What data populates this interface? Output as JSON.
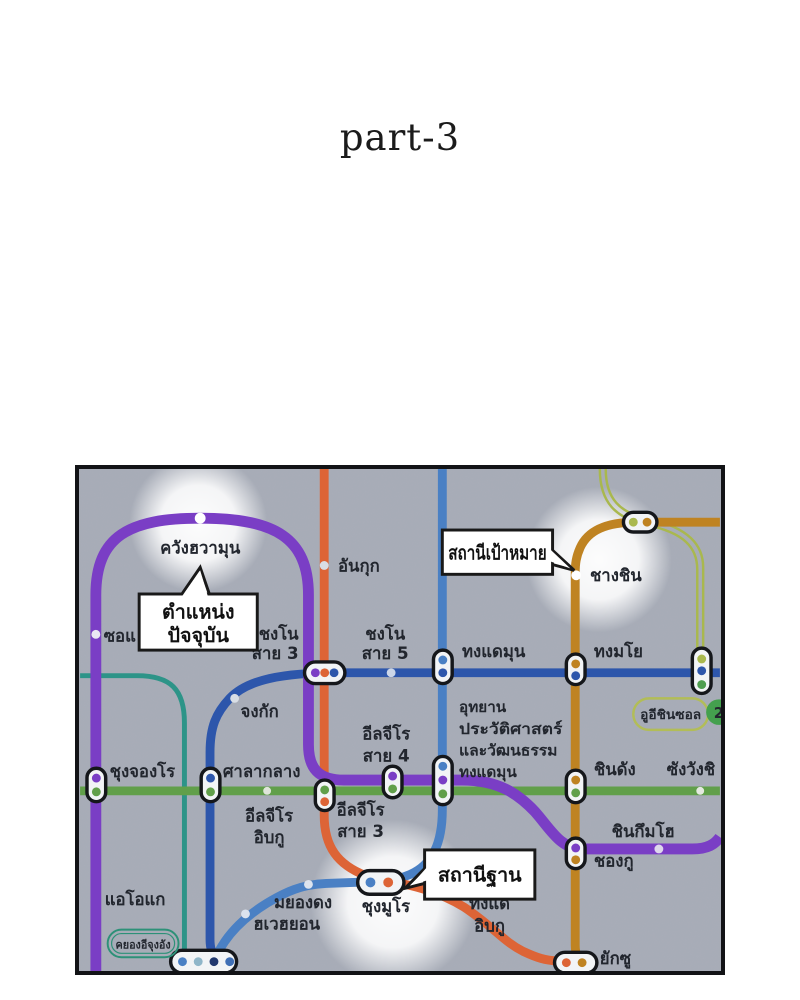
{
  "page": {
    "title": "part-3"
  },
  "colors": {
    "map_background": "#a7acb7",
    "line5_purple": "#7a3ec5",
    "line1_navy": "#2d56ab",
    "line4_blue": "#4a80c4",
    "line3_orange": "#dd6436",
    "line6_brown": "#bf8322",
    "line2_green": "#619f4a",
    "teal_line": "#2d9488",
    "ui_sinseol_olive": "#a9b84e"
  },
  "map": {
    "callouts": {
      "current_position": {
        "line1": "ตำแหน่ง",
        "line2": "ปัจจุบัน"
      },
      "destination_station": {
        "line1": "สถานีเป้าหมาย"
      },
      "base_station": {
        "line1": "สถานีฐาน"
      }
    },
    "badges": {
      "ui_sinseol": "อูอีชินซอล",
      "line2_number": "2",
      "gyeongui_jungang": "คยองอีจุงอัง"
    },
    "stations": {
      "gwanghwamun": "ควังฮวามุน",
      "seodaemun_partial": "ซอแ",
      "anguk": "อันกุก",
      "changsin": "ชางชิน",
      "jongno3_l1": "ชงโน",
      "jongno3_l2": "สาย 3",
      "jongno5_l1": "ชงโน",
      "jongno5_l2": "สาย 5",
      "dongdaemun": "ทงแดมุน",
      "dongmyo": "ทงมโย",
      "jonggak": "จงกัก",
      "ddm_park_l1": "อุทยาน",
      "ddm_park_l2": "ประวัติศาสตร์",
      "ddm_park_l3": "และวัฒนธรรม",
      "ddm_park_l4": "ทงแดมุน",
      "euljiro4_l1": "อีลจีโร",
      "euljiro4_l2": "สาย 4",
      "sindang": "ชินดัง",
      "sangwangsimni_partial": "ซังวังชิ",
      "chungjeongno": "ชุงจองโร",
      "cityhall": "ศาลากลาง",
      "euljiro1_l1": "อีลจีโร",
      "euljiro1_l2": "อิบกู",
      "euljiro3_l1": "อีลจีโร",
      "euljiro3_l2": "สาย 3",
      "aeogae": "แอโอแก",
      "myeongdong": "มยองดง",
      "hoehyeon": "ฮเวฮยอน",
      "chungmuro": "ชุงมูโร",
      "dongguk_l1": "ทงแด",
      "dongguk_l2": "อิบกู",
      "singeumho": "ชินกึมโฮ",
      "cheonggu": "ชองกู",
      "yaksu": "ยักซู"
    }
  }
}
